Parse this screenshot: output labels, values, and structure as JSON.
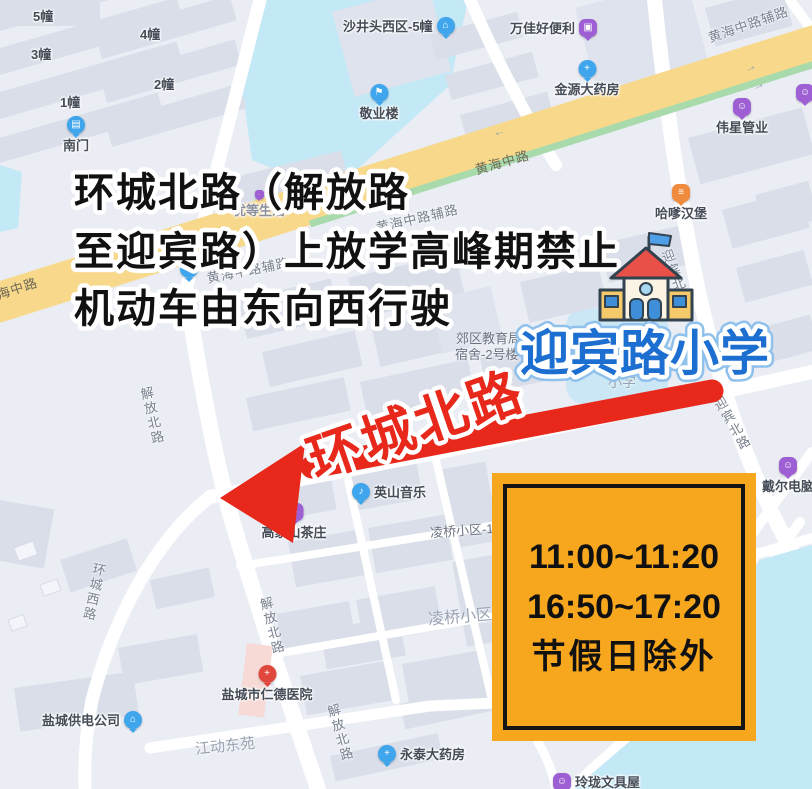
{
  "annotation": {
    "notice_line1": "环城北路（解放路",
    "notice_line2": "至迎宾路）上放学高峰期禁止",
    "notice_line3": "机动车由东向西行驶",
    "highlighted_road": "环城北路",
    "school_callout": "迎宾路小学"
  },
  "schedule_box": {
    "time_range_1": "11:00~11:20",
    "time_range_2": "16:50~17:20",
    "note": "节假日除外",
    "bg_color": "#F6A71E",
    "border_color": "#151515"
  },
  "colors": {
    "annotation_red": "#E7281B",
    "school_text_blue": "#1C6FD0",
    "notice_text_black": "#111111",
    "water": "#C3E8F6",
    "main_road_yellow": "#F8D98C"
  },
  "map": {
    "building_numbers": [
      "5幢",
      "4幢",
      "3幢",
      "2幢",
      "1幢"
    ],
    "icon_glyphs": {
      "gate-icon": "▤",
      "building-icon": "⌂",
      "flag-pin-icon": "⚑",
      "cart-icon": "▣",
      "pill-icon": "+",
      "bag-icon": "☺",
      "burger-icon": "≡",
      "music-icon": "♪",
      "hospital-icon": "+",
      "dot-icon": "·",
      "bus-icon": "▭",
      "road-arrow-icon": "→"
    },
    "pois": [
      {
        "label": "南门",
        "icon": "gate-icon"
      },
      {
        "label": "沙井头西区-5幢",
        "icon": "building-icon"
      },
      {
        "label": "敬业楼",
        "icon": "flag-pin-icon"
      },
      {
        "label": "万佳好便利",
        "icon": "cart-icon"
      },
      {
        "label": "金源大药房",
        "icon": "pill-icon"
      },
      {
        "label": "伟星管业",
        "icon": "bag-icon"
      },
      {
        "label": "优等生活",
        "icon": "dot-icon"
      },
      {
        "label": "哈嗲汉堡",
        "icon": "burger-icon"
      },
      {
        "label": "英山音乐",
        "icon": "music-icon"
      },
      {
        "label": "高家山茶庄",
        "icon": "bag-icon"
      },
      {
        "label": "戴尔电脑",
        "icon": "bag-icon"
      },
      {
        "label": "盐城供电公司",
        "icon": "building-icon"
      },
      {
        "label": "盐城市仁德医院",
        "icon": "hospital-icon"
      },
      {
        "label": "永泰大药房",
        "icon": "pill-icon"
      },
      {
        "label": "玲珑文具屋",
        "icon": "bag-icon"
      }
    ],
    "road_labels": [
      {
        "text": "黄海中路"
      },
      {
        "text": "海中路"
      },
      {
        "text": "黄海中路辅路"
      },
      {
        "text": "黄海中路辅路"
      },
      {
        "text": "黄海中路辅路"
      },
      {
        "text": "迎宾北路"
      },
      {
        "text": "迎宾北路"
      },
      {
        "text": "解放北路"
      },
      {
        "text": "解放北路"
      },
      {
        "text": "解放北路"
      },
      {
        "text": "环城西路"
      }
    ],
    "area_labels": [
      {
        "text": "郊区教育局"
      },
      {
        "text": "宿舍-2号楼"
      },
      {
        "text": "小学"
      },
      {
        "text": "凌桥小区-13"
      },
      {
        "text": "凌桥小区"
      },
      {
        "text": "江动东苑"
      }
    ]
  }
}
